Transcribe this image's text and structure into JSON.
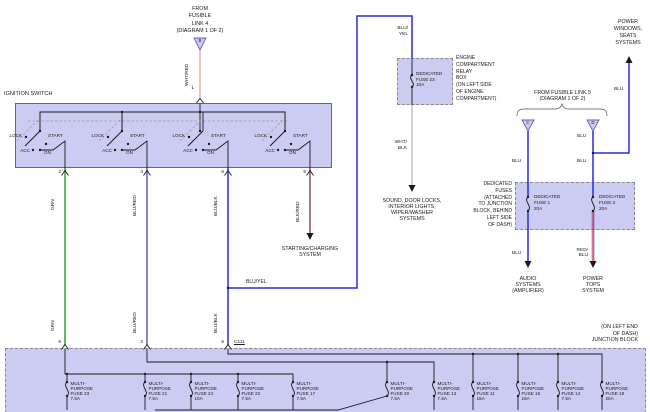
{
  "diagram": {
    "source_top": {
      "label": "FROM\nFUSIBLE\nLINK 4\n(DIAGRAM 1 OF 2)",
      "connector": "B",
      "wire": "WHT/RED",
      "pin": "1"
    },
    "ignition_switch": {
      "title": "IGNITION SWITCH",
      "positions": {
        "lock": "LOCK",
        "start": "START",
        "acc": "ACC",
        "on": "ON"
      },
      "pins": [
        "2",
        "4",
        "6",
        "5"
      ]
    },
    "wires": {
      "grn": "GRN",
      "blu_red": "BLU/RED",
      "blu_blk": "BLU/BLK",
      "blk_red": "BLK/RED",
      "blu_yel": "BLU/YEL",
      "blu_yel_2line": "BLU/\nYEL",
      "wht_blk": "WHT/\nBLK",
      "blu": "BLU",
      "red_blu": "RED/\nBLU"
    },
    "starting_charging": "STARTING/CHARGING\nSYSTEM",
    "relay_box": {
      "fuse": "DEDICATED\nFUSE 23\n10A",
      "note": "ENGINE\nCOMPARTMENT\nRELAY\nBOX\n(ON LEFT SIDE\nOF ENGINE\nCOMPARTMENT)"
    },
    "sound_systems": "SOUND, DOOR LOCKS,\nINTERIOR LIGHTS,\nWIPER/WASHER\nSYSTEMS",
    "power_windows": "POWER\nWINDOWS,\nSEATS\nSYSTEMS",
    "fusible_link5": {
      "label": "FROM FUSIBLE LINK 5\n(DIAGRAM 1 OF 2)",
      "connector_c": "C",
      "connector_d": "D"
    },
    "dedicated_fuses": {
      "note": "DEDICATED\nFUSES\n(ATTACHED\nTO JUNCTION\nBLOCK, BEHIND\nLEFT SIDE\nOF DASH)",
      "fuse1": "DEDICATED\nFUSE 1\n20A",
      "fuse3": "DEDICATED\nFUSE 3\n20A"
    },
    "audio_systems": "AUDIO\nSYSTEMS\n(AMPLIFIER)",
    "power_tops": "POWER\nTOPS\nSYSTEM",
    "junction_block": {
      "note": "(ON LEFT END\nOF DASH)\nJUNCTION BLOCK",
      "entries": [
        "6",
        "2",
        "5"
      ],
      "connector": "C111",
      "fuses": [
        {
          "label": "MULTI-\nPURPOSE\nFUSE 23\n7.5A"
        },
        {
          "label": "MULTI-\nPURPOSE\nFUSE 21\n7.5A"
        },
        {
          "label": "MULTI-\nPURPOSE\nFUSE 24\n10A"
        },
        {
          "label": "MULTI-\nPURPOSE\nFUSE 22\n7.5A"
        },
        {
          "label": "MULTI-\nPURPOSE\nFUSE 17\n7.5A"
        },
        {
          "label": "MULTI-\nPURPOSE\nFUSE 20\n7.5A"
        },
        {
          "label": "MULTI-\nPURPOSE\nFUSE 13\n7.5A"
        },
        {
          "label": "MULTI-\nPURPOSE\nFUSE 11\n15A"
        },
        {
          "label": "MULTI-\nPURPOSE\nFUSE 16\n15A"
        },
        {
          "label": "MULTI-\nPURPOSE\nFUSE 14\n7.5A"
        },
        {
          "label": "MULTI-\nPURPOSE\nFUSE 18\n20A"
        }
      ]
    }
  },
  "colors": {
    "grn": "#2aa52a",
    "blu_red": "#6157cf",
    "blu_blk": "#2b2be0",
    "blk_red": "#8a5252",
    "wht_red": "#eaaeae",
    "wht_blk": "#c2c2c2",
    "blu": "#2b2be0",
    "red": "#d03050",
    "lavender": "#ccccf2",
    "box_border": "#6060b0",
    "dash_border": "#8a8a8a",
    "ink": "#1a1a1a"
  }
}
